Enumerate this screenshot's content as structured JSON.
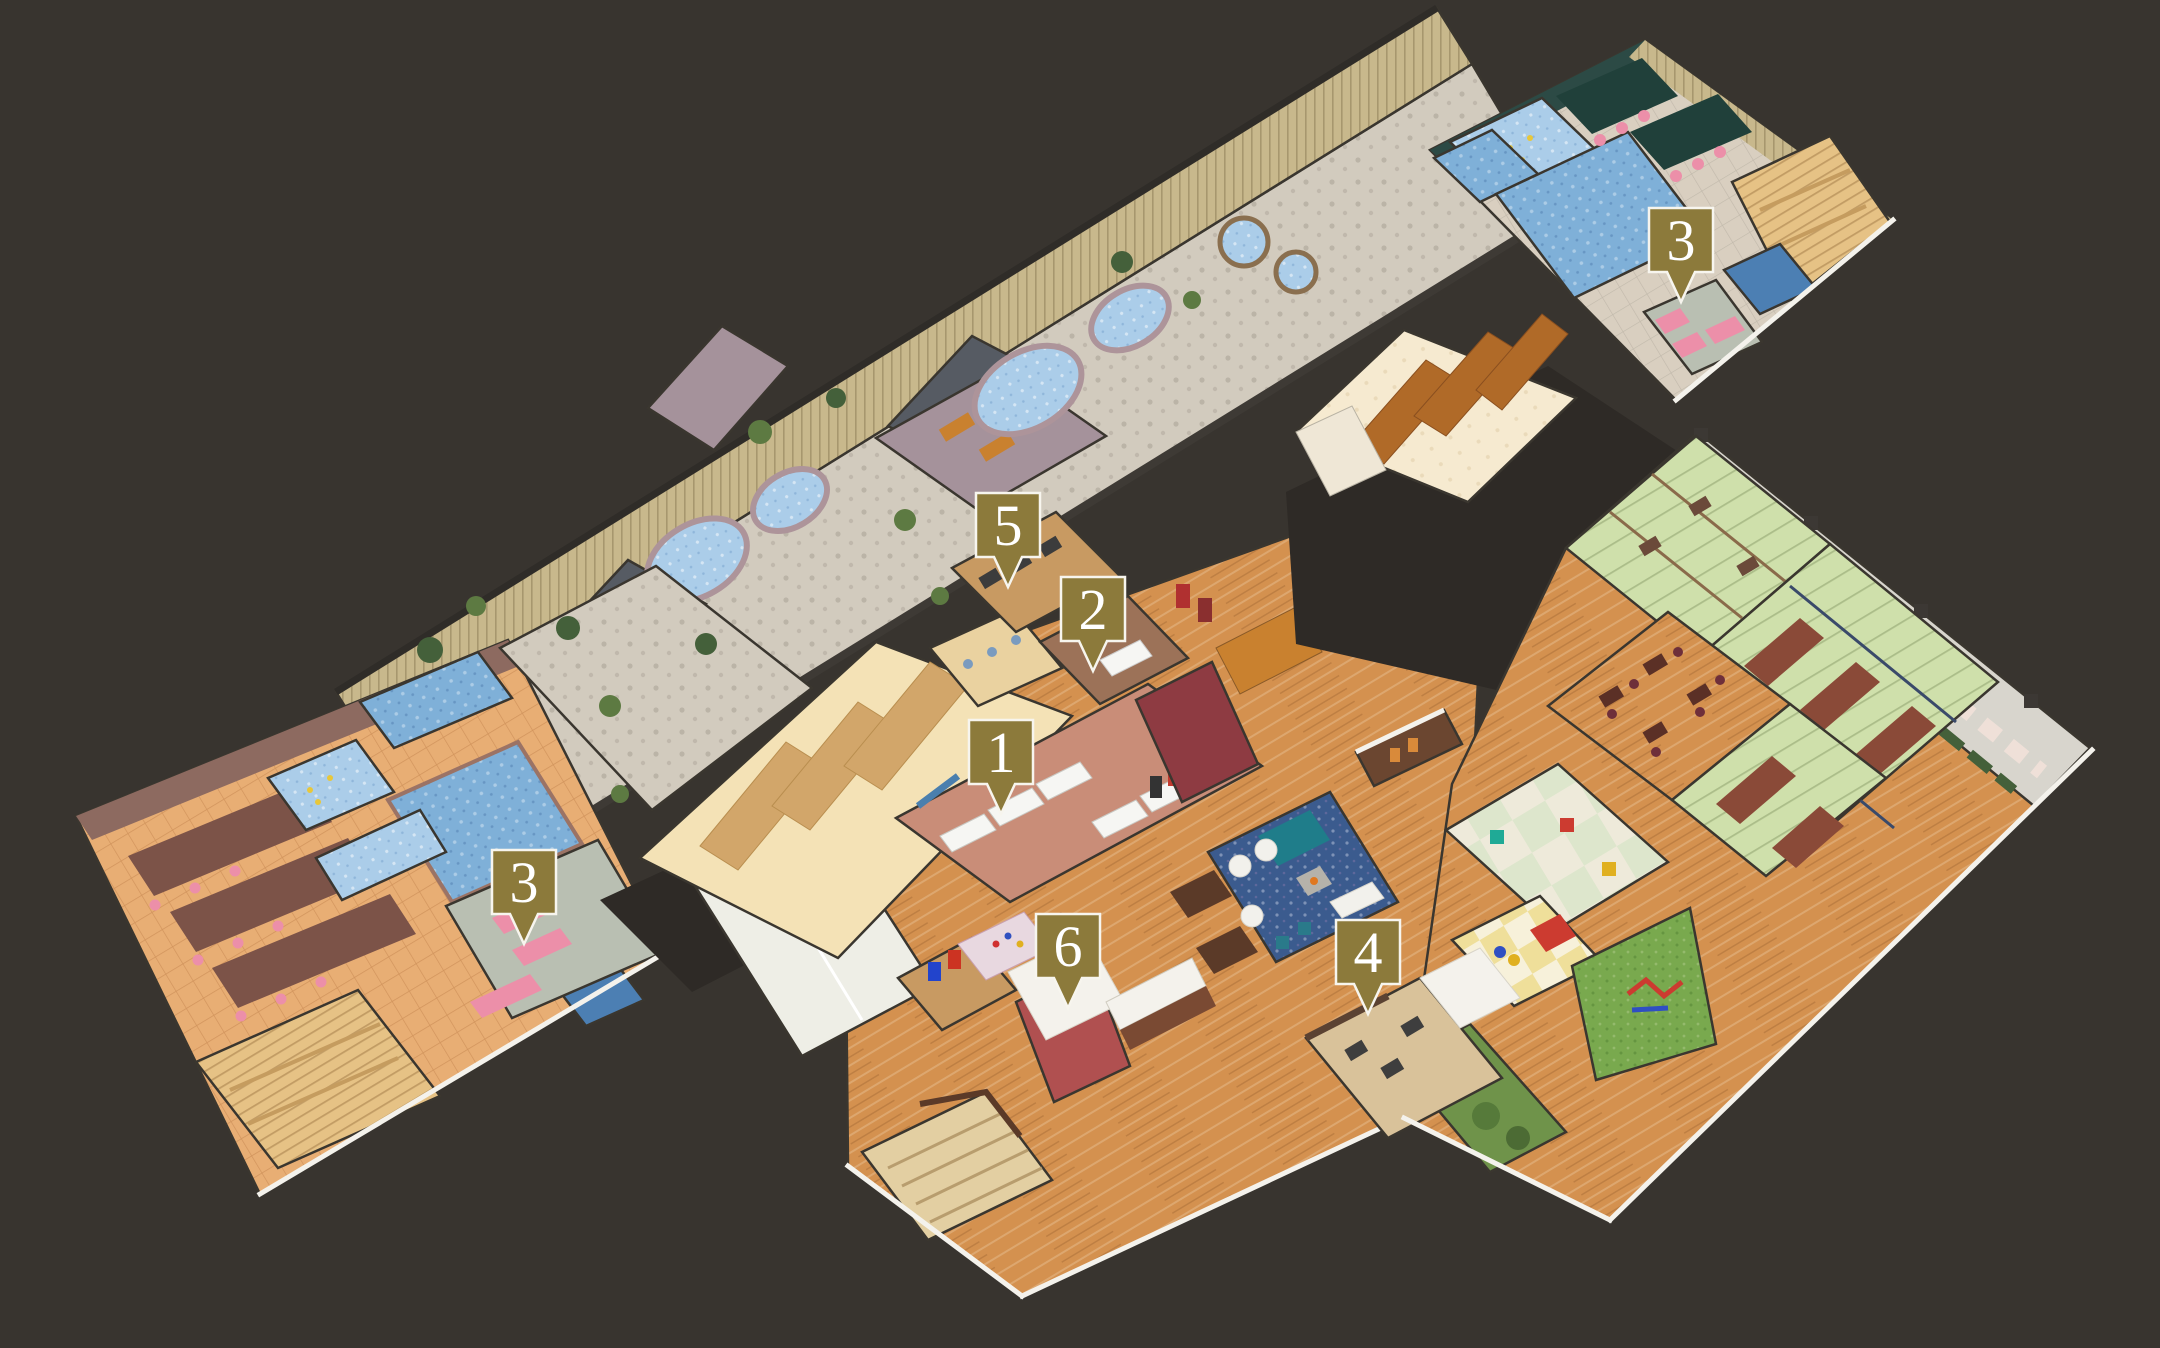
{
  "map": {
    "type": "isometric-facility-floor-guide",
    "markers": [
      {
        "label": "1",
        "x": 1001,
        "y": 752
      },
      {
        "label": "2",
        "x": 1093,
        "y": 609
      },
      {
        "label": "3",
        "x": 524,
        "y": 882
      },
      {
        "label": "3",
        "x": 1681,
        "y": 240
      },
      {
        "label": "4",
        "x": 1368,
        "y": 952
      },
      {
        "label": "5",
        "x": 1008,
        "y": 525
      },
      {
        "label": "6",
        "x": 1068,
        "y": 946
      }
    ]
  },
  "palette": {
    "bg": "#38342f",
    "marker_fill": "#8c7a3b",
    "marker_border": "#f7f5ee",
    "marker_text": "#ffffff",
    "wood_floor": "#d4914f",
    "tile_bath": "#e8ae74",
    "stone_floor": "#d2cbbe",
    "fence": "#c8b88c",
    "water": "#7fb0d8",
    "water_light": "#abcde9",
    "water_dark": "#4c7fb3",
    "tatami": "#cfe0ab",
    "pink": "#ec8fa9",
    "teal_wall": "#2c4a45",
    "grass": "#79a94e",
    "hedge": "#44603a",
    "carpet_blue": "#3b5b8e",
    "locker_tan": "#d2a66a",
    "locker_brown": "#b06a28",
    "dark_roof": "#2e2a26",
    "wall_white": "#f4f2ec",
    "brick_purple": "#a5929b",
    "roof_slate": "#565b63",
    "salmon": "#c98d78",
    "relax_gray": "#b9bfb2",
    "sauna_wood": "#e6c285"
  }
}
